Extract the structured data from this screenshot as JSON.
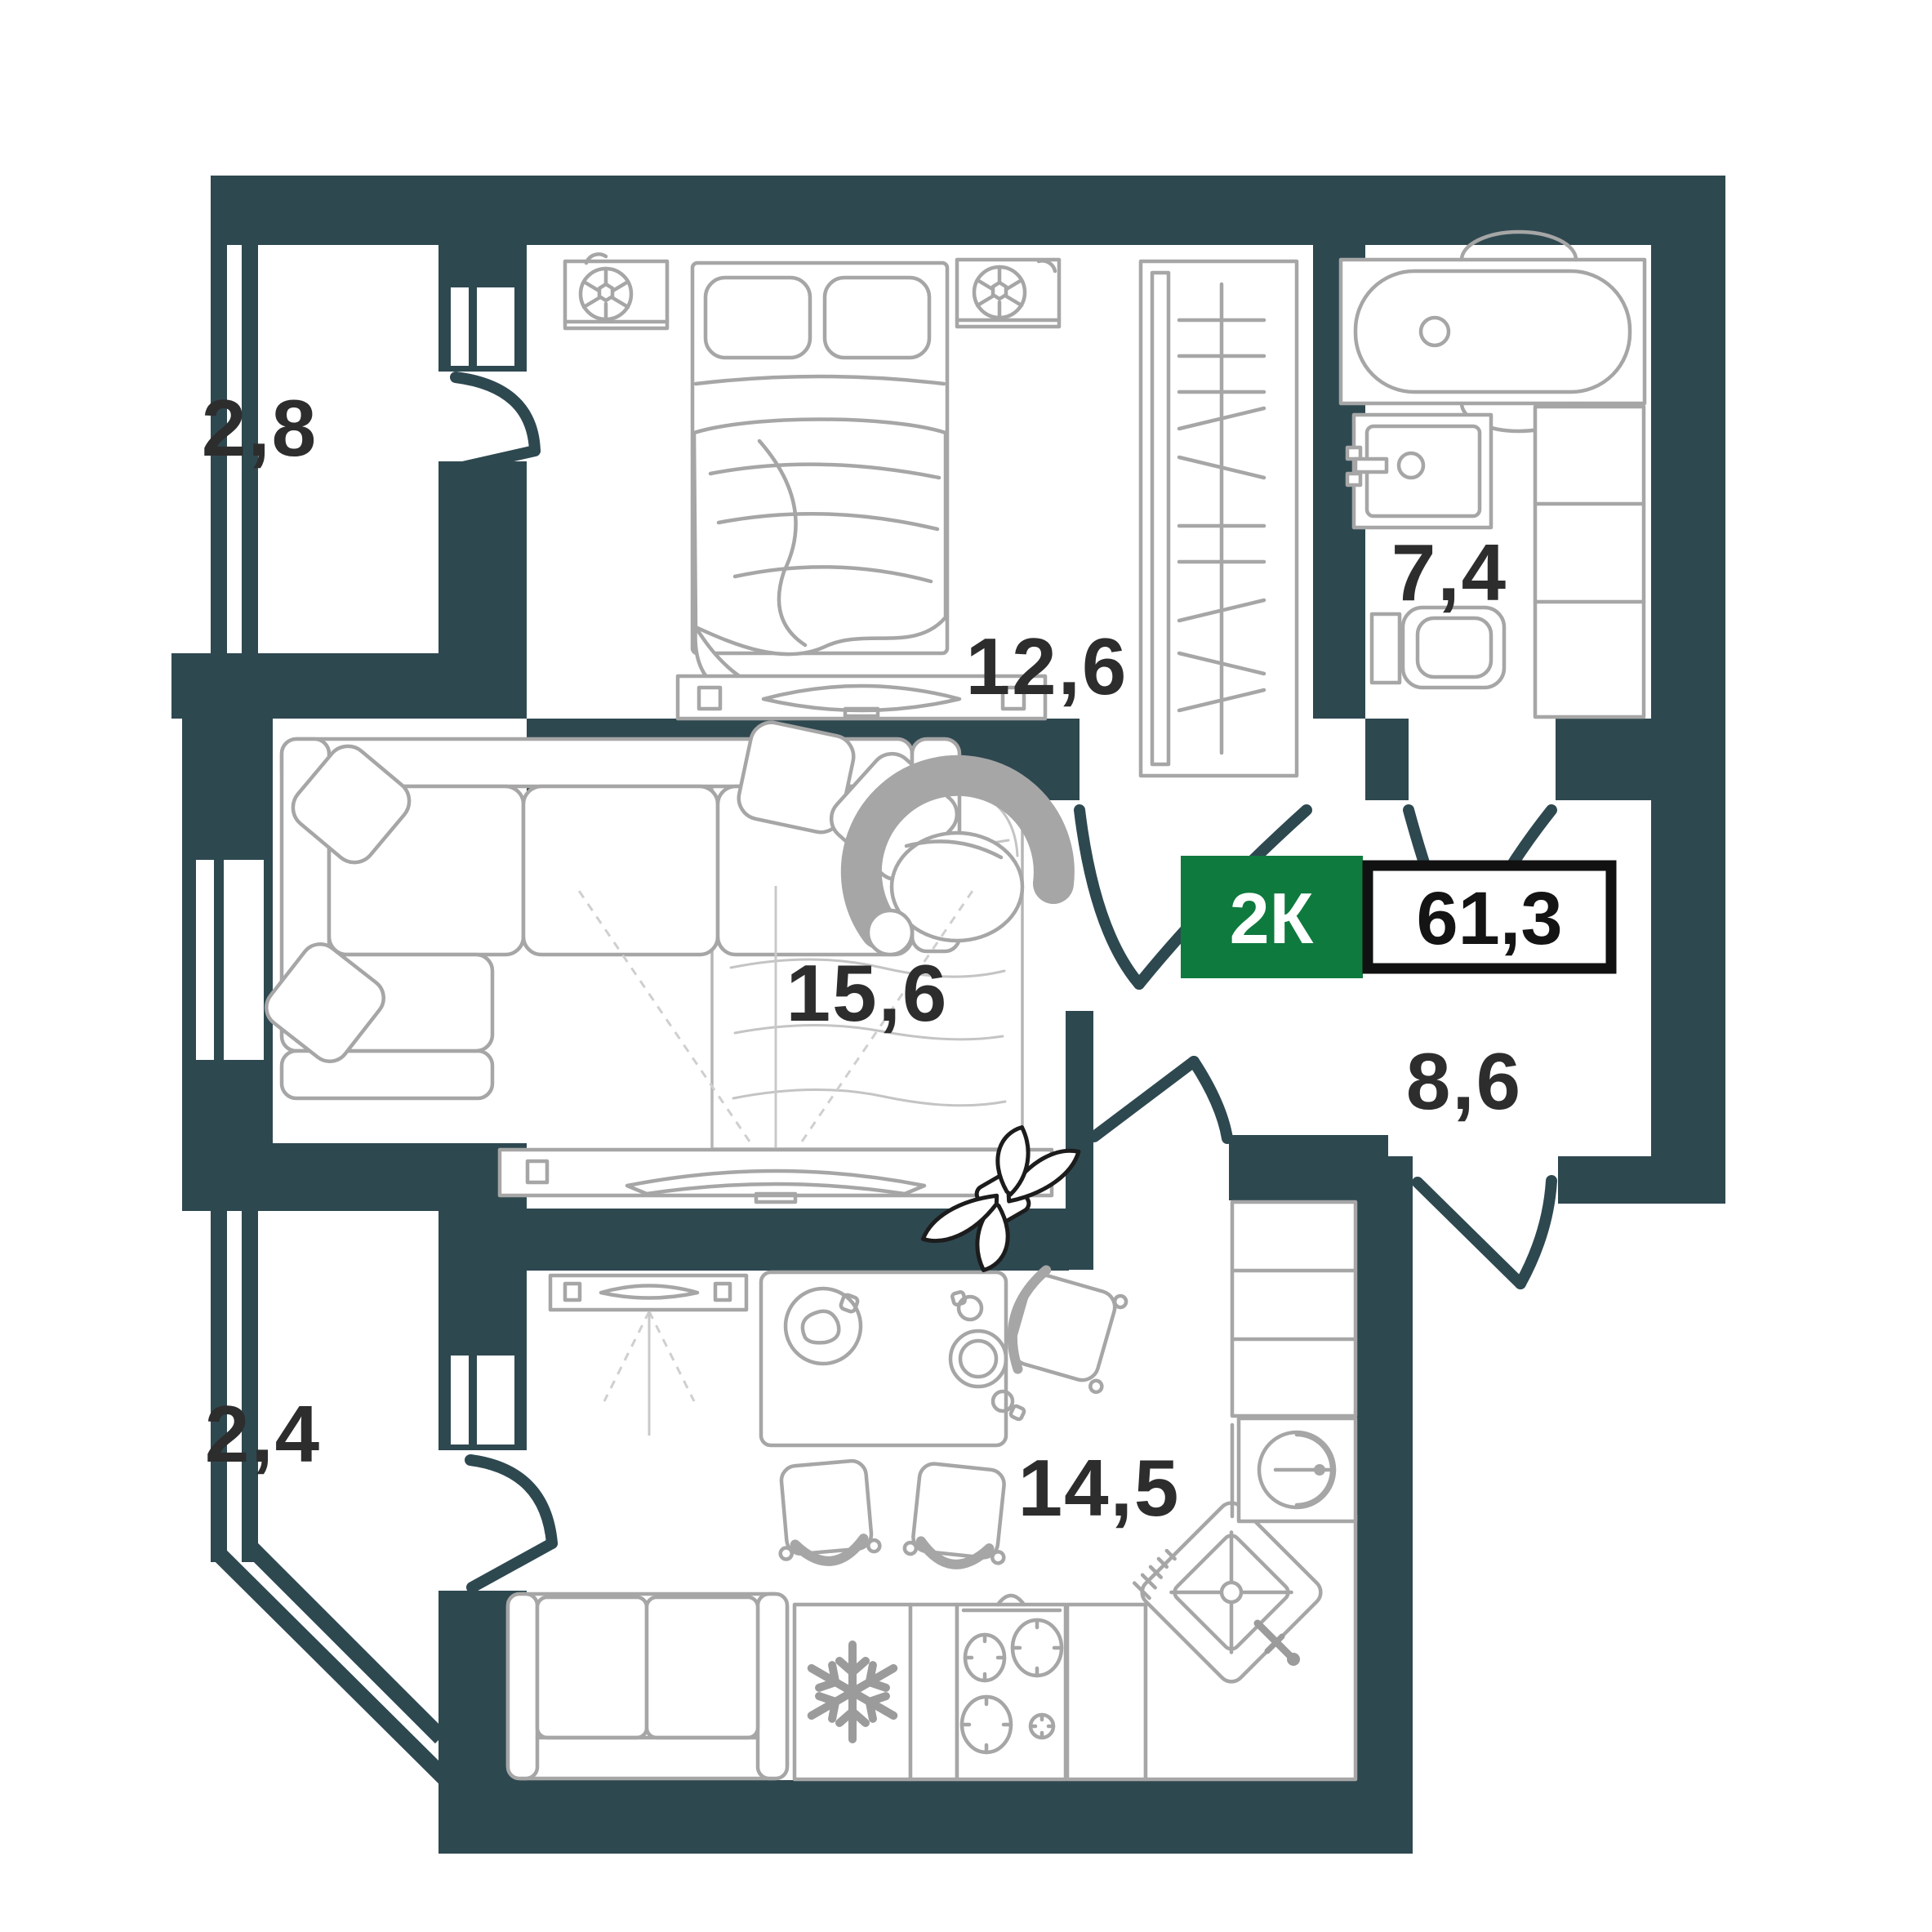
{
  "plan": {
    "title": "2-room apartment floor plan",
    "badge": {
      "type_label": "2К",
      "area_value": "61,3"
    },
    "rooms": [
      {
        "key": "balcony-top",
        "name": "balcony",
        "area": "2,8"
      },
      {
        "key": "bedroom",
        "name": "bedroom",
        "area": "12,6"
      },
      {
        "key": "bathroom",
        "name": "bathroom",
        "area": "7,4"
      },
      {
        "key": "living-room",
        "name": "living room",
        "area": "15,6"
      },
      {
        "key": "hallway",
        "name": "hallway",
        "area": "8,6"
      },
      {
        "key": "balcony-bottom",
        "name": "balcony",
        "area": "2,4"
      },
      {
        "key": "kitchen",
        "name": "kitchen",
        "area": "14,5"
      }
    ],
    "colors": {
      "wall": "#2e4850",
      "furniture_outline": "#a6a6a6",
      "label_text": "#2d2d2d",
      "badge_green": "#0f7a3e",
      "badge_border": "#111111",
      "badge_value_text": "#141414",
      "plant_outline": "#1c1c1c"
    }
  }
}
